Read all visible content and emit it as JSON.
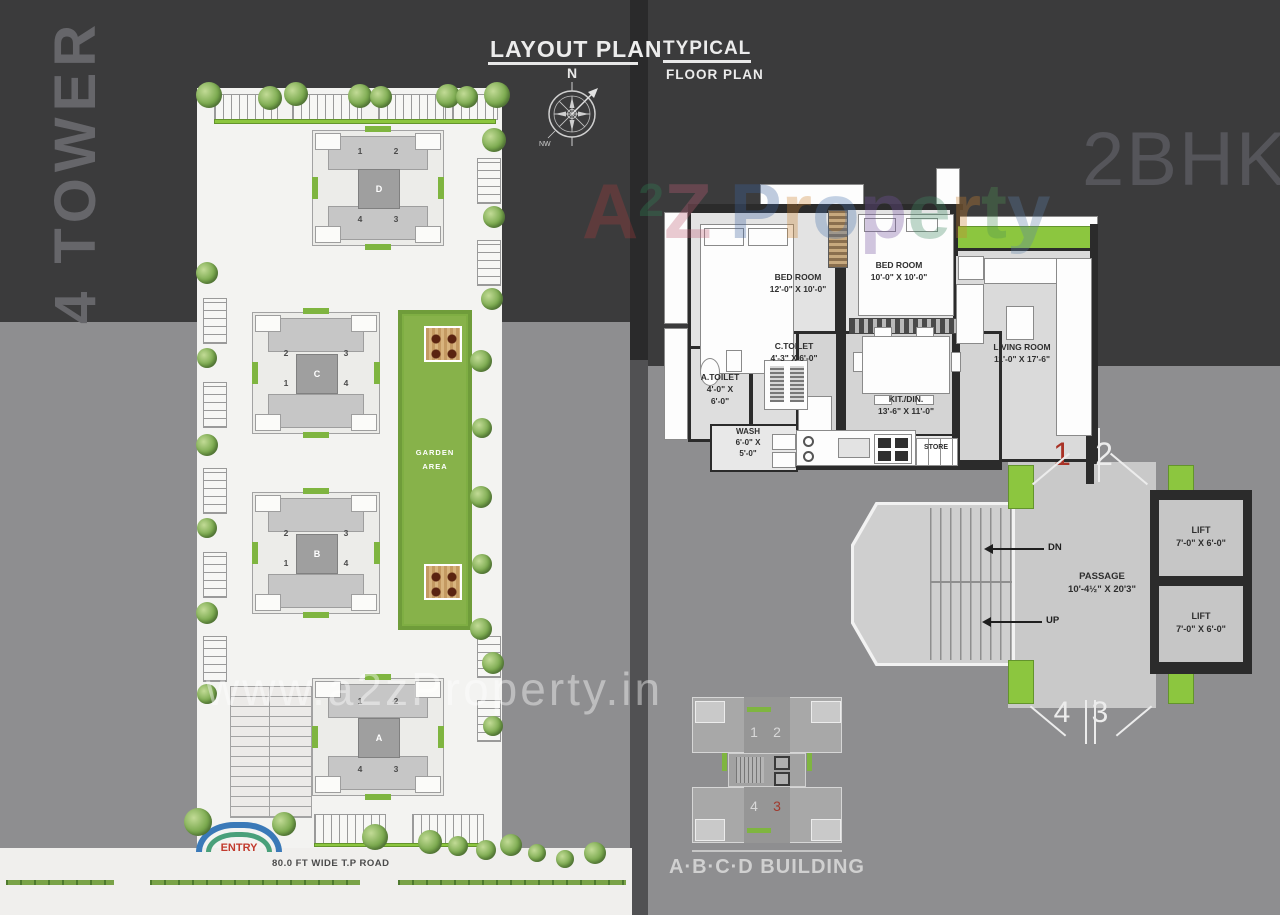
{
  "header": {
    "layout_plan": "LAYOUT PLAN",
    "typical": "TYPICAL",
    "floor_plan": "FLOOR PLAN",
    "tower_label": "4 TOWER",
    "unit_type": "2BHK",
    "compass_north": "N",
    "compass_nw": "NW"
  },
  "site_plan": {
    "garden_line1": "GARDEN",
    "garden_line2": "AREA",
    "entry_label": "ENTRY",
    "road_label": "80.0 FT WIDE T.P ROAD",
    "buildings": [
      {
        "letter": "D",
        "tl": "1",
        "tr": "2",
        "bl": "4",
        "br": "3"
      },
      {
        "letter": "C",
        "tl": "2",
        "tr": "3",
        "bl": "1",
        "br": "4"
      },
      {
        "letter": "B",
        "tl": "2",
        "tr": "3",
        "bl": "1",
        "br": "4"
      },
      {
        "letter": "A",
        "tl": "1",
        "tr": "2",
        "bl": "4",
        "br": "3"
      }
    ]
  },
  "floor_plan": {
    "bed1": {
      "name": "BED ROOM",
      "size": "12'-0\" X 10'-0\""
    },
    "bed2": {
      "name": "BED ROOM",
      "size": "10'-0\" X 10'-0\""
    },
    "living": {
      "name": "LIVING ROOM",
      "size": "11'-0\" X 17'-6\""
    },
    "ctoilet": {
      "name": "C.TOILET",
      "size": "4'-3\" X 6'-0\""
    },
    "atoilet": {
      "name": "A.TOILET",
      "size1": "4'-0\" X",
      "size2": "6'-0\""
    },
    "wash": {
      "name": "WASH",
      "size1": "6'-0\" X",
      "size2": "5'-0\""
    },
    "kitdin": {
      "name": "KIT./DIN.",
      "size": "13'-6\" X 11'-0\""
    },
    "store": {
      "name": "STORE"
    },
    "passage": {
      "name": "PASSAGE",
      "size": "10'-4½\" X 20'3\""
    },
    "lift": {
      "name": "LIFT",
      "size": "7'-0\" X 6'-0\""
    },
    "stairs": {
      "dn": "DN",
      "up": "UP"
    },
    "units": {
      "top_left": "1",
      "top_right": "2",
      "bottom_left": "4",
      "bottom_right": "3"
    }
  },
  "key_plan": {
    "title": "A·B·C·D BUILDING",
    "units": {
      "tl": "1",
      "tr": "2",
      "bl": "4",
      "br": "3"
    }
  },
  "watermark": {
    "brand": [
      "A",
      "2",
      "Z",
      "P",
      "r",
      "o",
      "p",
      "e",
      "r",
      "t",
      "y"
    ],
    "url": "www.a2zProperty.in"
  },
  "colors": {
    "accent_green": "#8cc63f",
    "highlight_red": "#a93226",
    "wall": "#2b2b2b",
    "background_dark": "#3b3b3c",
    "background_gray": "#8e8e90"
  }
}
